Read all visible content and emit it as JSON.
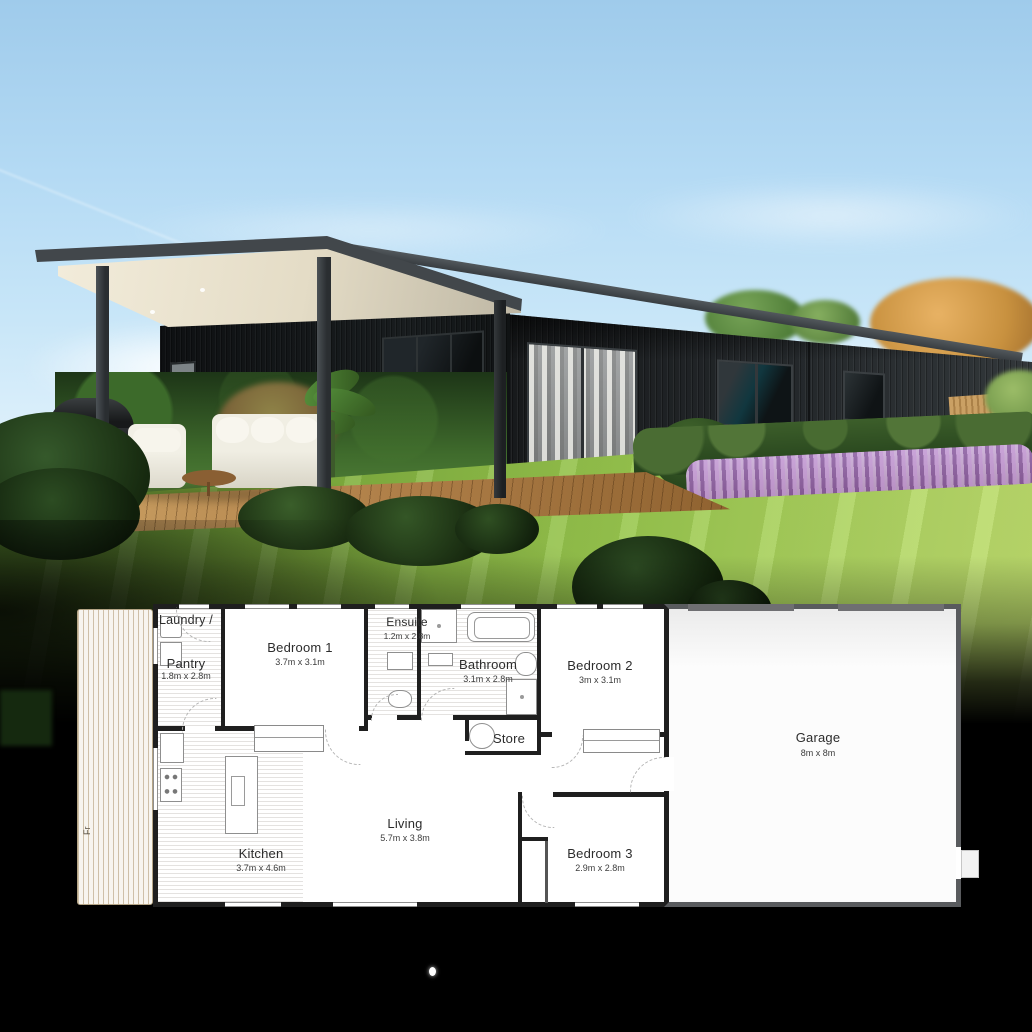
{
  "scene": {
    "type": "exterior-render-with-floor-plan",
    "description": "Single-storey black-clad home with covered deck, lawn and lavender hedge above its floor plan"
  },
  "colors": {
    "sky": "#b4daf4",
    "cladding_dark": "#1a1d1f",
    "roof_fascia": "#42474b",
    "soffit_cream": "#ece4cf",
    "lawn_green": "#8fbf4e",
    "hedge_green": "#33512a",
    "lavender_purple": "#b18cc4",
    "deck_wood": "#b08049",
    "plan_wall_black": "#1f1f1f",
    "garage_wall_gray": "#595b5e"
  },
  "floor_plan": {
    "deck": {
      "label": "Fr"
    },
    "rooms": {
      "laundry": {
        "label": "Laundry /"
      },
      "pantry": {
        "label": "Pantry",
        "dims": "1.8m x 2.8m"
      },
      "bedroom1": {
        "label": "Bedroom 1",
        "dims": "3.7m x 3.1m"
      },
      "ensuite": {
        "label": "Ensuite",
        "dims": "1.2m x 2.8m"
      },
      "bathroom": {
        "label": "Bathroom",
        "dims": "3.1m x 2.8m"
      },
      "bedroom2": {
        "label": "Bedroom 2",
        "dims": "3m x 3.1m"
      },
      "store": {
        "label": "Store"
      },
      "garage": {
        "label": "Garage",
        "dims": "8m x 8m"
      },
      "kitchen": {
        "label": "Kitchen",
        "dims": "3.7m x 4.6m"
      },
      "living": {
        "label": "Living",
        "dims": "5.7m x 3.8m"
      },
      "bedroom3": {
        "label": "Bedroom 3",
        "dims": "2.9m x 2.8m"
      }
    }
  }
}
